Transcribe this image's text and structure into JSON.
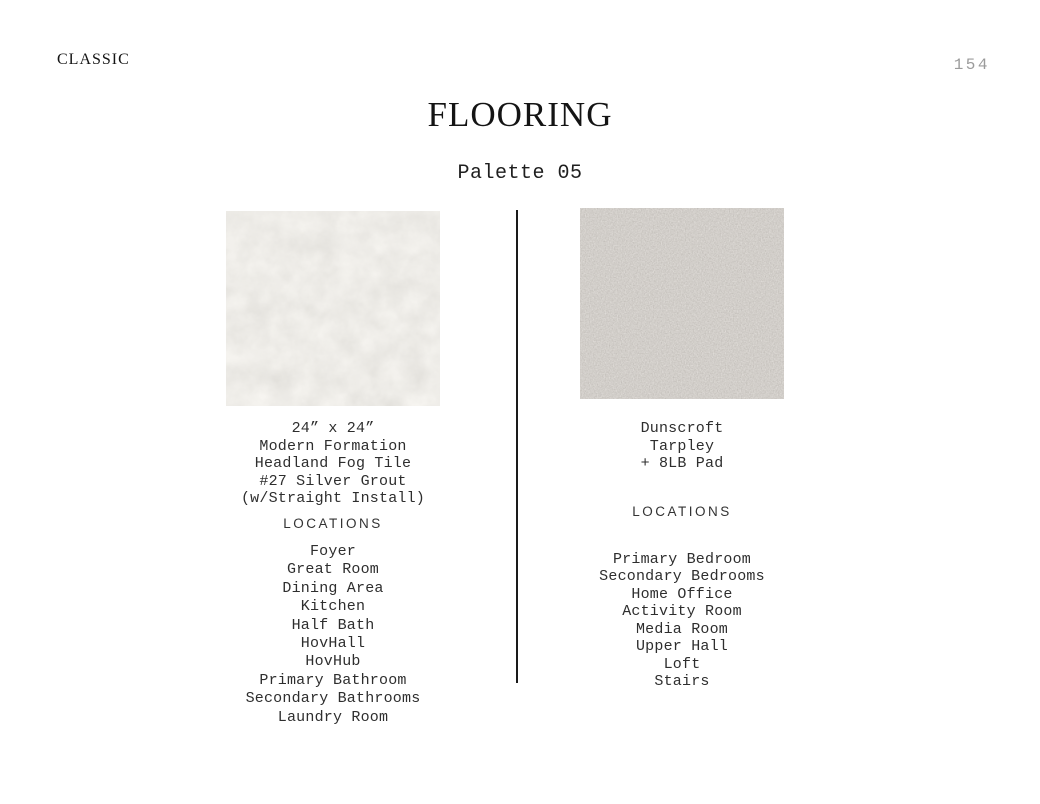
{
  "page": {
    "brand": "CLASSIC",
    "page_number": "154",
    "title": "FLOORING",
    "subtitle": "Palette 05"
  },
  "columns": [
    {
      "name": "tile",
      "swatch": "tile-texture-swatch",
      "spec_lines": [
        "24” x 24”",
        "Modern Formation",
        "Headland Fog Tile",
        "#27 Silver Grout",
        "(w/Straight Install)"
      ],
      "locations_heading": "LOCATIONS",
      "locations": [
        "Foyer",
        "Great Room",
        "Dining Area",
        "Kitchen",
        "Half Bath",
        "HovHall",
        "HovHub",
        "Primary Bathroom",
        "Secondary Bathrooms",
        "Laundry Room"
      ]
    },
    {
      "name": "carpet",
      "swatch": "carpet-texture-swatch",
      "spec_lines": [
        "Dunscroft",
        "Tarpley",
        "+ 8LB Pad"
      ],
      "locations_heading": "LOCATIONS",
      "locations": [
        "Primary Bedroom",
        "Secondary Bedrooms",
        "Home Office",
        "Activity Room",
        "Media Room",
        "Upper Hall",
        "Loft",
        "Stairs"
      ]
    }
  ],
  "colors": {
    "tile_swatch_base": "#d9d5cc",
    "carpet_swatch_base": "#a39d95",
    "divider": "#1a1a1a",
    "page_number_text": "#9b9b9b"
  }
}
